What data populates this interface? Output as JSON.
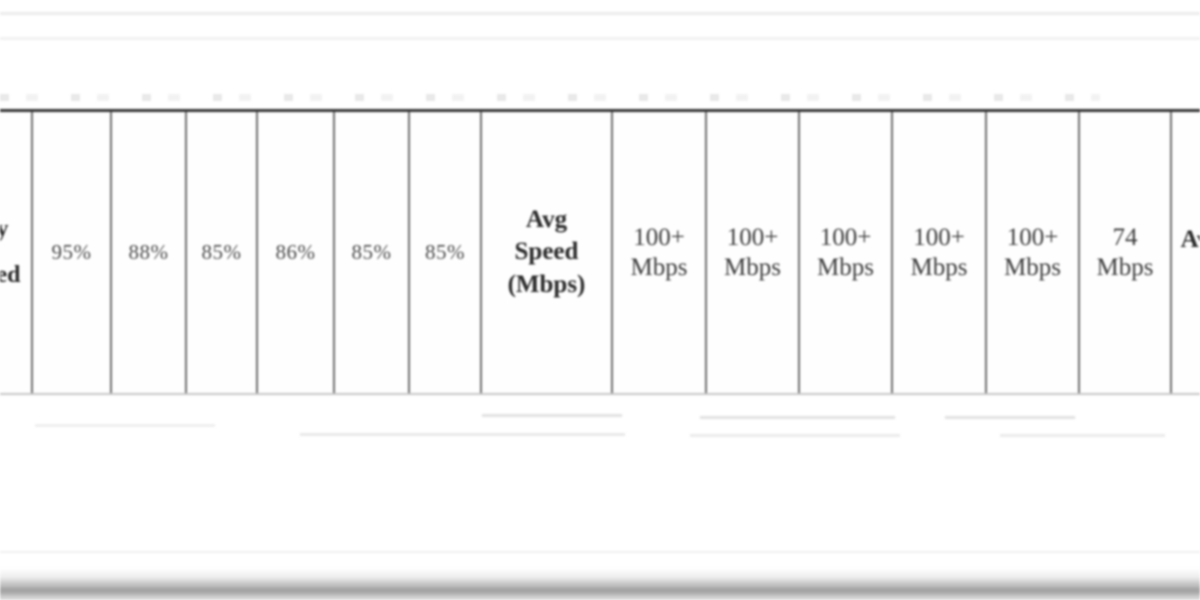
{
  "table_row": {
    "left_partial": {
      "line1": "y",
      "line2": "ed"
    },
    "percents": [
      "95%",
      "88%",
      "85%",
      "86%",
      "85%",
      "85%"
    ],
    "avg_speed_header": {
      "line1": "Avg",
      "line2": "Speed",
      "line3": "(Mbps)"
    },
    "speeds": [
      {
        "value": "100+",
        "unit": "Mbps"
      },
      {
        "value": "100+",
        "unit": "Mbps"
      },
      {
        "value": "100+",
        "unit": "Mbps"
      },
      {
        "value": "100+",
        "unit": "Mbps"
      },
      {
        "value": "100+",
        "unit": "Mbps"
      },
      {
        "value": "74",
        "unit": "Mbps"
      }
    ],
    "right_partial": "Av"
  }
}
